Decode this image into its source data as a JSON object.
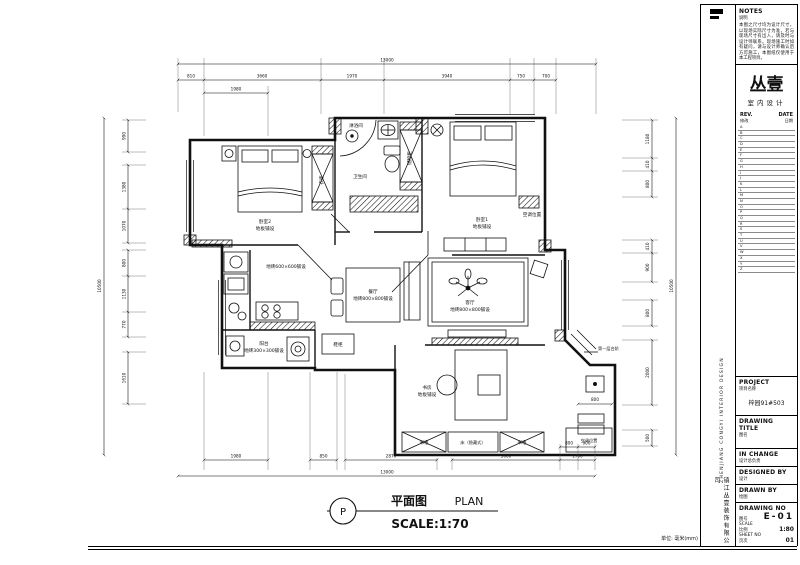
{
  "sheet": {
    "notes_title": "NOTES",
    "notes_subtitle": "说明",
    "notes_body": "本图之尺寸均为设计尺寸，以现场实际尺寸为准，若与现场尺寸有出入，请及时与设计师联系。现场施工时如有疑问，请与设计师确认后方可施工，本图纸仅使用于本工程项目。",
    "brand_name": "丛壹",
    "brand_subtitle": "室内设计",
    "rev_header": {
      "en_rev": "REV.",
      "en_date": "DATE",
      "cn_rev": "修改",
      "cn_date": "日期"
    },
    "rev_rows": [
      "A",
      "B",
      "C",
      "D",
      "E",
      "F",
      "G",
      "H",
      "I",
      "J",
      "K",
      "L",
      "M",
      "N",
      "O",
      "P",
      "Q",
      "R",
      "S",
      "T",
      "U",
      "V",
      "W",
      "X",
      "Y",
      "Z"
    ],
    "title_block": {
      "project_en": "PROJECT",
      "project_cn": "项目名称",
      "project_value": "梓园91#503",
      "drawing_title_en": "DRAWING  TITLE",
      "drawing_title_cn": "图名",
      "in_change_en": "IN CHANGE",
      "in_change_cn": "设计总负责",
      "designed_by_en": "DESIGNED BY",
      "designed_by_cn": "设计",
      "drawn_by_en": "DRAWN BY",
      "drawn_by_cn": "绘图",
      "drawing_no_en": "DRAWING NO",
      "drawing_no_cn": "图号",
      "drawing_no_value": "E-01",
      "scale_en": "SCALE",
      "scale_cn": "比例",
      "scale_value": "1:80",
      "sheet_no_en": "SHEET NO",
      "sheet_no_cn": "页次",
      "sheet_no_value": "01"
    },
    "side_text_en": "ZHENJIANG  CONGYI   INTERIOR   DESIGN",
    "side_text_cn": "镇江丛壹装饰有限公司",
    "units_note": "单位: 毫米(mm)"
  },
  "plan_title": {
    "marker": "P",
    "title_cn": "平面图",
    "title_en": "PLAN",
    "scale": "SCALE:1:70"
  },
  "rooms": {
    "bedroom2_name": "卧室2",
    "bedroom2_floor": "地板铺设",
    "wardrobe": "衣柜",
    "shower": "淋浴间",
    "bathroom": "卫生间",
    "storage": "储物柜",
    "bedroom1_name": "卧室1",
    "bedroom1_floor": "地板铺设",
    "ac_mid": "空调位置",
    "ac_bottom": "空调位置",
    "kitchen_floor": "地砖600×600铺设",
    "dining_name": "餐厅",
    "dining_floor": "地砖800×800铺设",
    "living_name": "客厅",
    "living_floor": "地砖800×800铺设",
    "balcony_name": "阳台",
    "balcony_floor": "地砖300×300铺设",
    "shoe_cabinet": "鞋柜",
    "study_name": "书房",
    "study_floor": "地板铺设",
    "bookcase_left": "书柜",
    "bookcase_right": "书柜",
    "hidden_bed": "床（隐藏式）",
    "steps": "第一层台阶"
  },
  "dims": {
    "top_overall": "13000",
    "top_1": "810",
    "top_2": "3660",
    "top_sub": "1980",
    "top_3": "1970",
    "top_4": "3940",
    "top_5": "750",
    "top_6": "700",
    "bottom_overall": "13000",
    "bottom_1": "1980",
    "bottom_2": "850",
    "bottom_3": "2870",
    "bottom_4": "3600",
    "bottom_5": "800",
    "bottom_6": "900",
    "bottom_7": "1700",
    "left_overall": "10500",
    "left_1": "990",
    "left_2": "1380",
    "left_3": "1070",
    "left_4": "800",
    "left_5": "1130",
    "left_6": "770",
    "left_7": "1610",
    "right_overall": "10500",
    "right_1": "1180",
    "right_2": "410",
    "right_3": "800",
    "right_4": "410",
    "right_5": "900",
    "right_6": "800",
    "right_7": "2000",
    "right_8": "500",
    "study_800": "800"
  }
}
